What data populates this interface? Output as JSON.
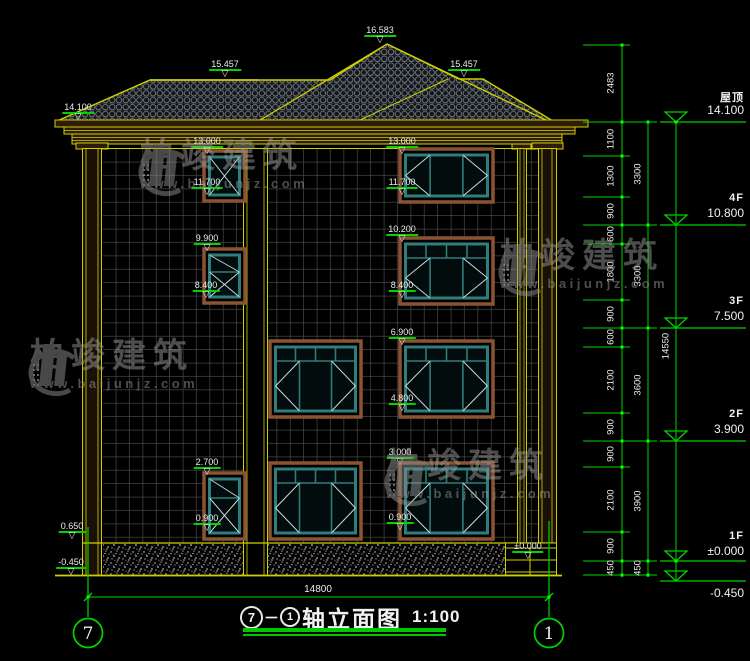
{
  "watermark": {
    "brand": "柏竣建筑",
    "url": "www.baijunjz.com"
  },
  "elevations": [
    "16.583",
    "15.457",
    "15.457",
    "14.100",
    "13.000",
    "11.700",
    "9.900",
    "8.400",
    "2.700",
    "0.900",
    "0.650",
    "-0.450",
    "13.000",
    "11.700",
    "10.200",
    "8.400",
    "6.900",
    "4.800",
    "3.000",
    "0.900",
    "±0.000"
  ],
  "dims": {
    "chain_inner": [
      "2483",
      "1100",
      "1300",
      "900",
      "600",
      "1800",
      "900",
      "600",
      "2100",
      "900",
      "900",
      "2100",
      "900",
      "450"
    ],
    "chain_mid": [
      "3300",
      "3300",
      "3600",
      "3900",
      "450"
    ],
    "chain_total": [
      "14550"
    ],
    "bottom_width": "14800"
  },
  "floors": [
    {
      "name": "屋顶",
      "value": "14.100"
    },
    {
      "name": "4F",
      "value": "10.800"
    },
    {
      "name": "3F",
      "value": "7.500"
    },
    {
      "name": "2F",
      "value": "3.900"
    },
    {
      "name": "1F",
      "value": "±0.000"
    },
    {
      "name": "",
      "value": "-0.450"
    }
  ],
  "axes": [
    "7",
    "1"
  ],
  "title": {
    "axis_from": "7",
    "dash": "－",
    "axis_to": "1",
    "name": "轴立面图",
    "scale": "1:100"
  },
  "colors": {
    "annotation_green": "#00d400",
    "line_yellow": "#cfcf00",
    "frame_teal": "#2f7d7d",
    "surround_brown": "#8a5332"
  }
}
